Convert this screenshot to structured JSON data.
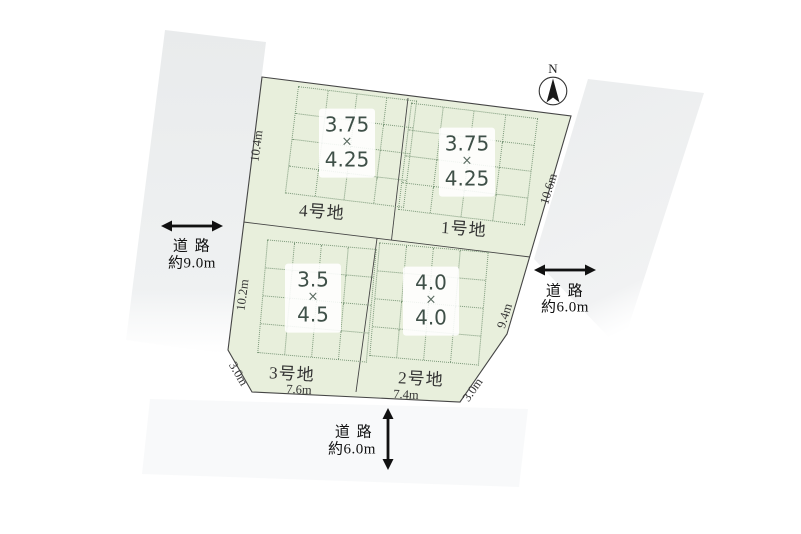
{
  "compass": {
    "north_label": "N"
  },
  "plots": [
    {
      "name": "1号地",
      "width": "3.75",
      "times": "×",
      "depth": "4.25"
    },
    {
      "name": "2号地",
      "width": "4.0",
      "times": "×",
      "depth": "4.0"
    },
    {
      "name": "3号地",
      "width": "3.5",
      "times": "×",
      "depth": "4.5"
    },
    {
      "name": "4号地",
      "width": "3.75",
      "times": "×",
      "depth": "4.25"
    }
  ],
  "edge_dimensions": {
    "left_upper": "10.4m",
    "left_lower": "10.2m",
    "right_upper": "10.6m",
    "right_lower": "9.4m",
    "bottom_left_corner": "3.0m",
    "bottom_left": "7.6m",
    "bottom_right": "7.4m",
    "bottom_right_corner": "3.0m"
  },
  "roads": {
    "west": {
      "label": "道 路",
      "width": "約9.0m"
    },
    "east": {
      "label": "道 路",
      "width": "約6.0m"
    },
    "south": {
      "label": "道 路",
      "width": "約6.0m"
    }
  },
  "colors": {
    "site_fill": "#e8efdc",
    "grid_dot": "#7b9879",
    "number_text": "#3f5048",
    "outline": "#454545",
    "road_fill": "#ebedee"
  }
}
